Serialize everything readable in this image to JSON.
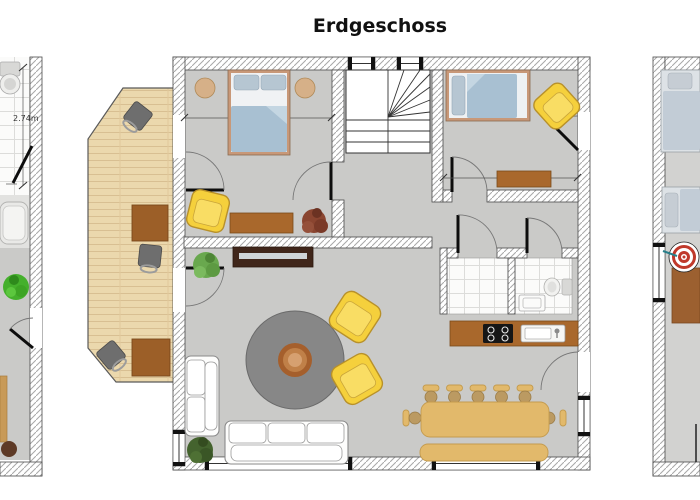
{
  "page_title": "Erdgeschoss",
  "plan": {
    "main_unit": {
      "rooms": [
        {
          "name": "bedroom-1",
          "furniture": [
            "double-bed",
            "nightstand",
            "nightstand",
            "yellow-armchair",
            "desk",
            "plant"
          ]
        },
        {
          "name": "stair-hall",
          "furniture": [
            "u-shaped-staircase"
          ]
        },
        {
          "name": "bedroom-2",
          "furniture": [
            "single-bed",
            "yellow-armchair",
            "dresser"
          ]
        },
        {
          "name": "hallway",
          "furniture": []
        },
        {
          "name": "bathroom-1",
          "furniture": []
        },
        {
          "name": "bathroom-2",
          "furniture": [
            "toilet",
            "washbasin"
          ]
        },
        {
          "name": "kitchen",
          "furniture": [
            "kitchen-counter",
            "cooktop",
            "kitchen-sink"
          ]
        },
        {
          "name": "living-room",
          "furniture": [
            "tv-sideboard",
            "round-rug",
            "round-coffee-table",
            "yellow-armchair",
            "yellow-armchair",
            "three-seat-sofa",
            "two-seat-sofa",
            "plant",
            "plant"
          ]
        },
        {
          "name": "dining-area",
          "furniture": [
            "dining-table",
            "dining-chair",
            "dining-chair",
            "dining-chair",
            "dining-chair",
            "dining-chair",
            "dining-chair",
            "dining-chair",
            "bench"
          ]
        }
      ]
    },
    "terrace": {
      "furniture": [
        "wood-deck",
        "outdoor-table",
        "outdoor-table",
        "outdoor-chair",
        "outdoor-chair",
        "outdoor-chair"
      ]
    },
    "left_partial_unit": {
      "dimension_label": "2.74m",
      "furniture": [
        "toilet",
        "bathtub",
        "plant",
        "wood-sideboard",
        "stool"
      ]
    },
    "right_partial_unit": {
      "furniture": [
        "bed",
        "bed",
        "dartboard",
        "table"
      ]
    }
  },
  "colors": {
    "floor": "#cacac8",
    "floor_light": "#e2e2e0",
    "right_floor": "#d2d2d0",
    "wall_hatch": "#a8a8a8",
    "deck_wood": "#ebd8ad",
    "bed_duvet": "#a8c0d2",
    "bed_pillow": "#b6c6d2",
    "bed_frame": "#c89878",
    "chair_yellow": "#f5d03c",
    "wood_brown": "#a9682c",
    "tv_dark": "#40261a",
    "rug_gray": "#878787",
    "dining_tan": "#e2b96b",
    "plant_green": "#69a84e",
    "plant_dark_green": "#3f5c2a",
    "plant_bright_green": "#45b02c",
    "plant_red": "#8a4530",
    "dartboard_red": "#c0392b",
    "title_color": "#111111"
  }
}
